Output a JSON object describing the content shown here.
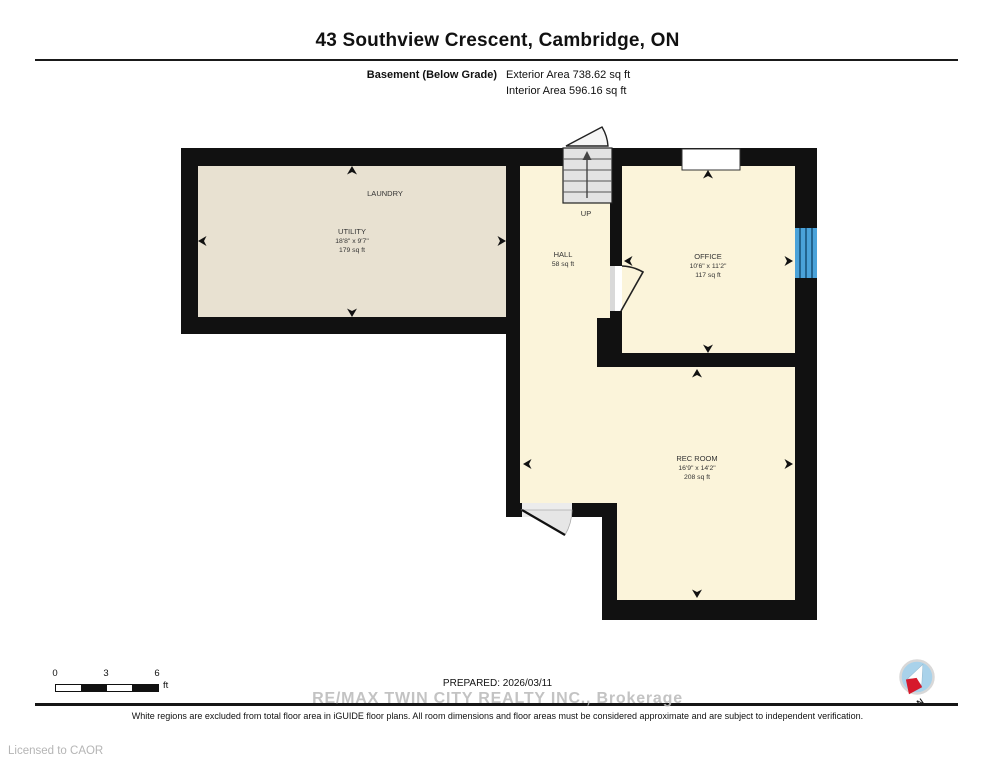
{
  "header": {
    "title": "43 Southview Crescent, Cambridge, ON",
    "floor_label": "Basement (Below Grade)",
    "exterior_area": "Exterior Area 738.62 sq ft",
    "interior_area": "Interior Area 596.16 sq ft"
  },
  "rooms": {
    "laundry": {
      "name": "LAUNDRY"
    },
    "utility": {
      "name": "UTILITY",
      "dimensions": "18'8\" x 9'7\"",
      "area": "179 sq ft"
    },
    "hall": {
      "name": "HALL",
      "area": "58 sq ft"
    },
    "office": {
      "name": "OFFICE",
      "dimensions": "10'6\" x 11'2\"",
      "area": "117 sq ft"
    },
    "rec_room": {
      "name": "REC ROOM",
      "dimensions": "16'9\" x 14'2\"",
      "area": "208 sq ft"
    },
    "stairs": {
      "direction_label": "UP"
    }
  },
  "scale_bar": {
    "tick0": "0",
    "tick1": "3",
    "tick2": "6",
    "unit": "ft"
  },
  "footer": {
    "prepared": "PREPARED: 2026/03/11",
    "watermark": "RE/MAX TWIN CITY REALTY INC., Brokerage",
    "disclaimer": "White regions are excluded from total floor area in iGUIDE floor plans. All room dimensions and floor areas must be considered approximate and are subject to independent verification.",
    "license": "Licensed to CAOR"
  },
  "compass": {
    "label": "N"
  },
  "colors": {
    "wall": "#111111",
    "room_fill": "#FBF4DA",
    "utility_fill": "#E8E1D1",
    "stairs_fill": "#E3E3E3",
    "window_blue": "#4AA2D9",
    "compass_blue": "#A9D2EA",
    "needle_red": "#D6192B"
  }
}
